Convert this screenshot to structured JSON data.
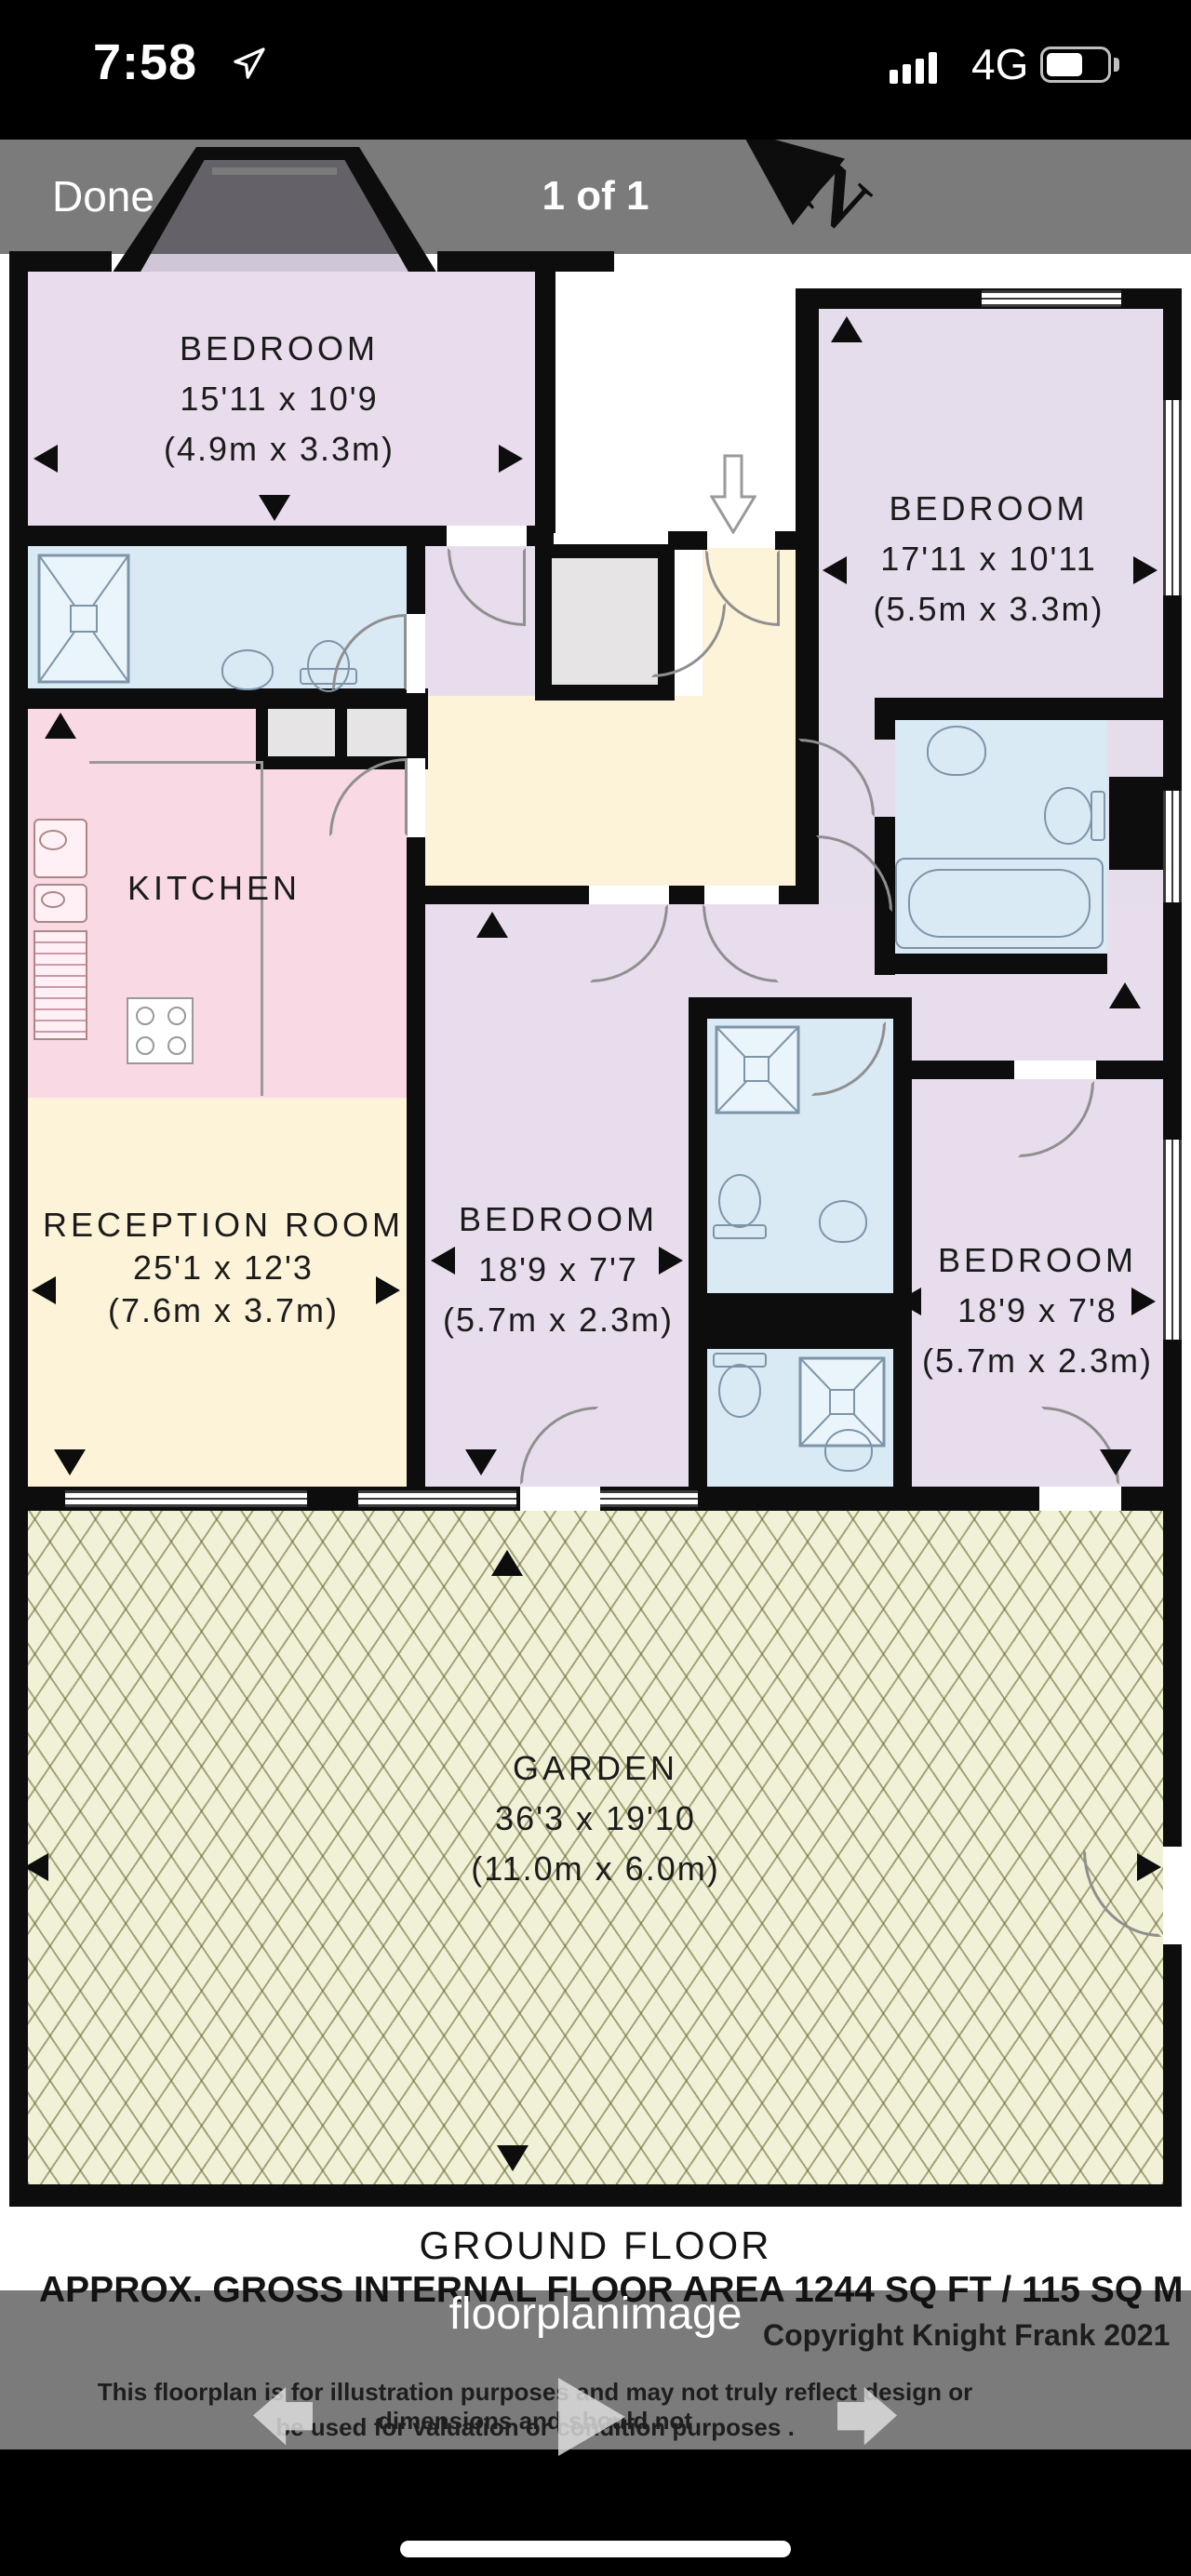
{
  "status_bar": {
    "time": "7:58",
    "network": "4G"
  },
  "viewer_header": {
    "done_label": "Done",
    "page_indicator": "1 of 1"
  },
  "floorplan": {
    "rooms": [
      {
        "id": "bedroom-top-left",
        "name": "BEDROOM",
        "dims_ft": "15'11 x 10'9",
        "dims_m": "(4.9m x 3.3m)"
      },
      {
        "id": "bedroom-top-right",
        "name": "BEDROOM",
        "dims_ft": "17'11 x 10'11",
        "dims_m": "(5.5m x 3.3m)"
      },
      {
        "id": "kitchen",
        "name": "KITCHEN",
        "dims_ft": "",
        "dims_m": ""
      },
      {
        "id": "reception-room",
        "name": "RECEPTION ROOM",
        "dims_ft": "25'1 x 12'3",
        "dims_m": "(7.6m x 3.7m)"
      },
      {
        "id": "bedroom-middle",
        "name": "BEDROOM",
        "dims_ft": "18'9 x 7'7",
        "dims_m": "(5.7m x 2.3m)"
      },
      {
        "id": "bedroom-right",
        "name": "BEDROOM",
        "dims_ft": "18'9 x 7'8",
        "dims_m": "(5.7m x 2.3m)"
      },
      {
        "id": "garden",
        "name": "GARDEN",
        "dims_ft": "36'3 x 19'10",
        "dims_m": "(11.0m x 6.0m)"
      }
    ],
    "compass_letter": "N",
    "floor_label": "GROUND FLOOR",
    "area_label": "APPROX. GROSS INTERNAL FLOOR AREA 1244 SQ FT / 115 SQ M",
    "copyright": "Copyright Knight Frank 2021",
    "disclaimer_line1": "This floorplan is for illustration purposes and may not truly reflect design or dimensions and should not",
    "disclaimer_line2": "be used for valuation or condition purposes ."
  },
  "watermark": {
    "text": "floorplanimage"
  },
  "icons": {
    "location_icon": "location-arrow",
    "cellular_icon": "cellular-bars",
    "battery_icon": "battery",
    "compass_icon": "north-arrow",
    "entrance_icon": "entrance-arrow",
    "back_icon": "back-arrow",
    "play_icon": "play-arrow",
    "forward_icon": "forward-arrow"
  },
  "colors": {
    "room_lilac": "#e8dded",
    "room_pink": "#f8d9e4",
    "room_blue": "#d9eaf5",
    "room_cream": "#fdf3d8",
    "room_gray": "#e6e4e4",
    "garden": "#f0f1d6",
    "wall": "#0d0d0d",
    "overlay": "#787878"
  }
}
